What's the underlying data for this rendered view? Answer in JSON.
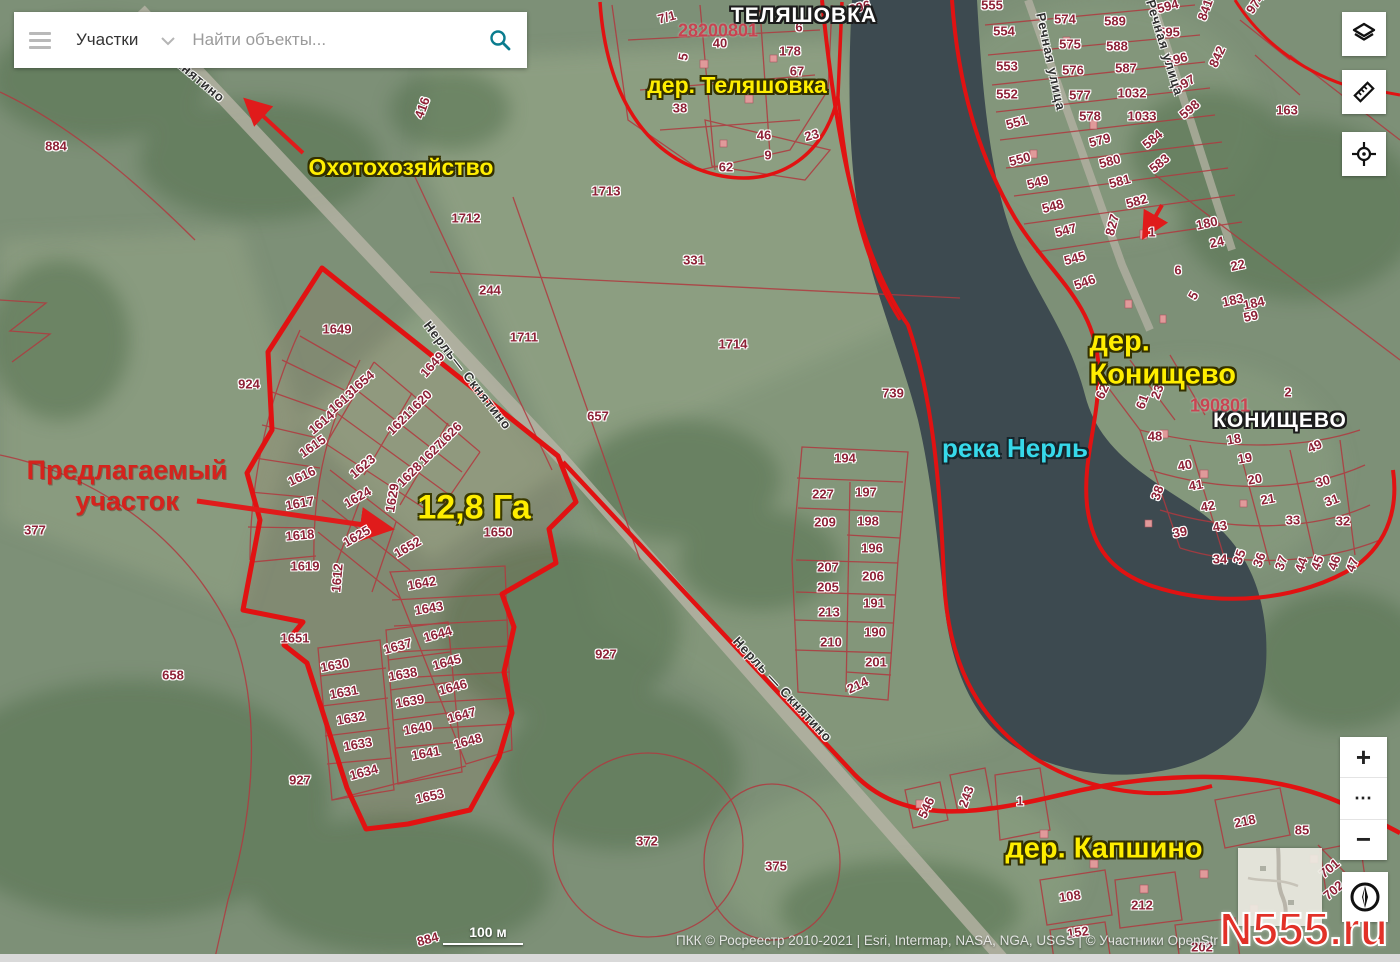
{
  "search": {
    "category": "Участки",
    "placeholder": "Найти объекты..."
  },
  "controls": {
    "layers_icon": "layers",
    "ruler_icon": "ruler",
    "locate_icon": "crosshair",
    "zoom_in": "+",
    "more": "⋯",
    "zoom_out": "−",
    "compass_icon": "compass"
  },
  "scale_bar": {
    "label": "100 м"
  },
  "attribution": "ПКК © Росреестр 2010-2021 | Esri, Intermap, NASA, NGA, USGS | © Участники OpenStr",
  "watermark": "N555.ru",
  "colors": {
    "accent_red": "#e11212",
    "label_yellow": "#ffee00",
    "river_cyan": "#37d9ea",
    "water": "#3d4a50"
  },
  "map_labels": [
    {
      "t": "ТЕЛЯШОВКА",
      "x": 804,
      "y": 16,
      "cls": "place",
      "name": "place-label-telyashovka"
    },
    {
      "t": "КОНИЩЕВО",
      "x": 1280,
      "y": 421,
      "cls": "place",
      "name": "place-label-konishchevo"
    },
    {
      "t": "дер. Теляшовка",
      "x": 737,
      "y": 85,
      "cls": "village",
      "name": "village-label-telyashovka"
    },
    {
      "t": "дер. Конищево",
      "x": 1193,
      "y": 359,
      "cls": "village-lg",
      "name": "village-label-konishchevo"
    },
    {
      "t": "дер. Капшино",
      "x": 1104,
      "y": 849,
      "cls": "village-lg",
      "name": "village-label-kapshino"
    },
    {
      "t": "Охотохозяйство",
      "x": 401,
      "y": 167,
      "cls": "village",
      "name": "hunting-ground-label"
    },
    {
      "t": "12,8 Га",
      "x": 474,
      "y": 508,
      "cls": "area-size",
      "name": "area-size-label"
    },
    {
      "t": "река Нерль",
      "x": 1015,
      "y": 449,
      "cls": "river",
      "name": "river-label"
    },
    {
      "t": "Предлагаемый\nучасток",
      "x": 127,
      "y": 486,
      "cls": "callout",
      "name": "proposed-parcel-callout"
    },
    {
      "t": "Скнятино",
      "x": 196,
      "y": 78,
      "cls": "road",
      "r": 40,
      "name": "road-label"
    },
    {
      "t": "Нерль— Скнятино",
      "x": 467,
      "y": 376,
      "cls": "road",
      "r": 52,
      "name": "road-label"
    },
    {
      "t": "Нерль — Скнятино",
      "x": 782,
      "y": 690,
      "cls": "road",
      "r": 47,
      "name": "road-label"
    },
    {
      "t": "Речная улица",
      "x": 1050,
      "y": 62,
      "cls": "road",
      "r": 78,
      "name": "street-label"
    },
    {
      "t": "Речная улица",
      "x": 1164,
      "y": 48,
      "cls": "road",
      "r": 73,
      "name": "street-label"
    },
    {
      "t": "28200801",
      "x": 718,
      "y": 31,
      "cls": "quarter",
      "name": "cadastral-quarter-number"
    },
    {
      "t": "190801",
      "x": 1220,
      "y": 406,
      "cls": "quarter",
      "name": "cadastral-quarter-number"
    }
  ],
  "parcels": [
    {
      "t": "884",
      "x": 56,
      "y": 147
    },
    {
      "t": "896",
      "x": 860,
      "y": 8,
      "r": -15
    },
    {
      "t": "416",
      "x": 423,
      "y": 108,
      "r": -70
    },
    {
      "t": "924",
      "x": 249,
      "y": 385
    },
    {
      "t": "377",
      "x": 35,
      "y": 531
    },
    {
      "t": "658",
      "x": 173,
      "y": 676
    },
    {
      "t": "884",
      "x": 428,
      "y": 940,
      "r": -15
    },
    {
      "t": "7/1",
      "x": 667,
      "y": 18,
      "r": -15
    },
    {
      "t": "40",
      "x": 720,
      "y": 44
    },
    {
      "t": "5",
      "x": 684,
      "y": 57,
      "r": -80
    },
    {
      "t": "6",
      "x": 799,
      "y": 28
    },
    {
      "t": "178",
      "x": 790,
      "y": 52
    },
    {
      "t": "67",
      "x": 797,
      "y": 72
    },
    {
      "t": "38",
      "x": 680,
      "y": 109
    },
    {
      "t": "46",
      "x": 764,
      "y": 136
    },
    {
      "t": "23",
      "x": 812,
      "y": 136,
      "r": -15
    },
    {
      "t": "9",
      "x": 768,
      "y": 156
    },
    {
      "t": "62",
      "x": 726,
      "y": 168
    },
    {
      "t": "1713",
      "x": 606,
      "y": 192
    },
    {
      "t": "1712",
      "x": 466,
      "y": 219
    },
    {
      "t": "331",
      "x": 694,
      "y": 261
    },
    {
      "t": "244",
      "x": 490,
      "y": 291
    },
    {
      "t": "1711",
      "x": 524,
      "y": 338
    },
    {
      "t": "1714",
      "x": 733,
      "y": 345
    },
    {
      "t": "657",
      "x": 598,
      "y": 417
    },
    {
      "t": "739",
      "x": 893,
      "y": 394
    },
    {
      "t": "1649",
      "x": 337,
      "y": 330
    },
    {
      "t": "1649",
      "x": 433,
      "y": 365,
      "r": -48
    },
    {
      "t": "1654",
      "x": 362,
      "y": 383,
      "r": -40
    },
    {
      "t": "1613",
      "x": 342,
      "y": 402,
      "r": -40
    },
    {
      "t": "1614",
      "x": 322,
      "y": 423,
      "r": -40
    },
    {
      "t": "1615",
      "x": 313,
      "y": 447,
      "r": -35
    },
    {
      "t": "1616",
      "x": 302,
      "y": 477,
      "r": -25
    },
    {
      "t": "1617",
      "x": 300,
      "y": 504,
      "r": -10
    },
    {
      "t": "1618",
      "x": 300,
      "y": 536,
      "r": -5
    },
    {
      "t": "1619",
      "x": 305,
      "y": 567
    },
    {
      "t": "1620",
      "x": 420,
      "y": 403,
      "r": -45
    },
    {
      "t": "1621",
      "x": 400,
      "y": 423,
      "r": -45
    },
    {
      "t": "1626",
      "x": 450,
      "y": 435,
      "r": -45
    },
    {
      "t": "1627",
      "x": 432,
      "y": 453,
      "r": -45
    },
    {
      "t": "1623",
      "x": 363,
      "y": 467,
      "r": -40
    },
    {
      "t": "1628",
      "x": 410,
      "y": 475,
      "r": -45
    },
    {
      "t": "1624",
      "x": 358,
      "y": 498,
      "r": -30
    },
    {
      "t": "1629",
      "x": 393,
      "y": 498,
      "r": -80
    },
    {
      "t": "1625",
      "x": 357,
      "y": 537,
      "r": -30
    },
    {
      "t": "1652",
      "x": 408,
      "y": 548,
      "r": -30
    },
    {
      "t": "1612",
      "x": 338,
      "y": 578,
      "r": -85
    },
    {
      "t": "1650",
      "x": 498,
      "y": 533
    },
    {
      "t": "1651",
      "x": 295,
      "y": 639
    },
    {
      "t": "927",
      "x": 300,
      "y": 781
    },
    {
      "t": "1642",
      "x": 422,
      "y": 584,
      "r": -10
    },
    {
      "t": "1643",
      "x": 429,
      "y": 609,
      "r": -10
    },
    {
      "t": "1637",
      "x": 398,
      "y": 647,
      "r": -15
    },
    {
      "t": "1644",
      "x": 438,
      "y": 635,
      "r": -15
    },
    {
      "t": "1645",
      "x": 447,
      "y": 663,
      "r": -15
    },
    {
      "t": "1630",
      "x": 335,
      "y": 666,
      "r": -10
    },
    {
      "t": "1638",
      "x": 403,
      "y": 675,
      "r": -10
    },
    {
      "t": "1646",
      "x": 453,
      "y": 688,
      "r": -15
    },
    {
      "t": "1631",
      "x": 344,
      "y": 693,
      "r": -10
    },
    {
      "t": "1639",
      "x": 410,
      "y": 702,
      "r": -10
    },
    {
      "t": "1632",
      "x": 351,
      "y": 719,
      "r": -10
    },
    {
      "t": "1647",
      "x": 462,
      "y": 716,
      "r": -15
    },
    {
      "t": "1640",
      "x": 418,
      "y": 729,
      "r": -10
    },
    {
      "t": "1633",
      "x": 358,
      "y": 745,
      "r": -10
    },
    {
      "t": "1648",
      "x": 468,
      "y": 742,
      "r": -15
    },
    {
      "t": "1641",
      "x": 426,
      "y": 754,
      "r": -10
    },
    {
      "t": "1634",
      "x": 364,
      "y": 773,
      "r": -15
    },
    {
      "t": "1653",
      "x": 430,
      "y": 797,
      "r": -12
    },
    {
      "t": "194",
      "x": 845,
      "y": 459
    },
    {
      "t": "227",
      "x": 823,
      "y": 495
    },
    {
      "t": "197",
      "x": 866,
      "y": 493
    },
    {
      "t": "209",
      "x": 825,
      "y": 523
    },
    {
      "t": "198",
      "x": 868,
      "y": 522
    },
    {
      "t": "196",
      "x": 872,
      "y": 549
    },
    {
      "t": "207",
      "x": 828,
      "y": 568
    },
    {
      "t": "206",
      "x": 873,
      "y": 577
    },
    {
      "t": "205",
      "x": 828,
      "y": 588
    },
    {
      "t": "213",
      "x": 829,
      "y": 613
    },
    {
      "t": "191",
      "x": 874,
      "y": 604
    },
    {
      "t": "210",
      "x": 831,
      "y": 643
    },
    {
      "t": "190",
      "x": 875,
      "y": 633
    },
    {
      "t": "201",
      "x": 876,
      "y": 663
    },
    {
      "t": "214",
      "x": 858,
      "y": 686,
      "r": -25
    },
    {
      "t": "555",
      "x": 992,
      "y": 6
    },
    {
      "t": "554",
      "x": 1004,
      "y": 32
    },
    {
      "t": "553",
      "x": 1007,
      "y": 67
    },
    {
      "t": "552",
      "x": 1007,
      "y": 95
    },
    {
      "t": "551",
      "x": 1017,
      "y": 123,
      "r": -15
    },
    {
      "t": "550",
      "x": 1020,
      "y": 160,
      "r": -15
    },
    {
      "t": "549",
      "x": 1038,
      "y": 183,
      "r": -15
    },
    {
      "t": "548",
      "x": 1053,
      "y": 207,
      "r": -15
    },
    {
      "t": "547",
      "x": 1066,
      "y": 231,
      "r": -15
    },
    {
      "t": "545",
      "x": 1075,
      "y": 259,
      "r": -15
    },
    {
      "t": "546",
      "x": 1085,
      "y": 283,
      "r": -20
    },
    {
      "t": "574",
      "x": 1065,
      "y": 20
    },
    {
      "t": "575",
      "x": 1070,
      "y": 45
    },
    {
      "t": "576",
      "x": 1073,
      "y": 71
    },
    {
      "t": "577",
      "x": 1080,
      "y": 96
    },
    {
      "t": "578",
      "x": 1090,
      "y": 117
    },
    {
      "t": "579",
      "x": 1100,
      "y": 141,
      "r": -15
    },
    {
      "t": "580",
      "x": 1110,
      "y": 162,
      "r": -15
    },
    {
      "t": "581",
      "x": 1120,
      "y": 182,
      "r": -15
    },
    {
      "t": "582",
      "x": 1137,
      "y": 202,
      "r": -15
    },
    {
      "t": "589",
      "x": 1115,
      "y": 22
    },
    {
      "t": "588",
      "x": 1117,
      "y": 47
    },
    {
      "t": "587",
      "x": 1126,
      "y": 69
    },
    {
      "t": "1032",
      "x": 1132,
      "y": 94
    },
    {
      "t": "1033",
      "x": 1142,
      "y": 117
    },
    {
      "t": "584",
      "x": 1153,
      "y": 140,
      "r": -40
    },
    {
      "t": "583",
      "x": 1160,
      "y": 164,
      "r": -40
    },
    {
      "t": "594",
      "x": 1168,
      "y": 7,
      "r": -15
    },
    {
      "t": "595",
      "x": 1169,
      "y": 33
    },
    {
      "t": "596",
      "x": 1177,
      "y": 60,
      "r": -15
    },
    {
      "t": "597",
      "x": 1185,
      "y": 84,
      "r": -30
    },
    {
      "t": "598",
      "x": 1190,
      "y": 110,
      "r": -40
    },
    {
      "t": "827",
      "x": 1113,
      "y": 225,
      "r": -75
    },
    {
      "t": "841",
      "x": 1206,
      "y": 10,
      "r": -70
    },
    {
      "t": "842",
      "x": 1218,
      "y": 57,
      "r": -65
    },
    {
      "t": "974",
      "x": 1256,
      "y": 4,
      "r": -55
    },
    {
      "t": "163",
      "x": 1287,
      "y": 111
    },
    {
      "t": "1",
      "x": 1152,
      "y": 233
    },
    {
      "t": "180",
      "x": 1207,
      "y": 224,
      "r": -12
    },
    {
      "t": "24",
      "x": 1217,
      "y": 243,
      "r": -12
    },
    {
      "t": "22",
      "x": 1238,
      "y": 266,
      "r": -12
    },
    {
      "t": "6",
      "x": 1178,
      "y": 271
    },
    {
      "t": "5",
      "x": 1194,
      "y": 296,
      "r": -60
    },
    {
      "t": "183",
      "x": 1233,
      "y": 301,
      "r": -12
    },
    {
      "t": "184",
      "x": 1254,
      "y": 304,
      "r": -12
    },
    {
      "t": "59",
      "x": 1251,
      "y": 317,
      "r": -12
    },
    {
      "t": "62",
      "x": 1103,
      "y": 392,
      "r": -65
    },
    {
      "t": "61",
      "x": 1143,
      "y": 402,
      "r": -70
    },
    {
      "t": "23",
      "x": 1158,
      "y": 392,
      "r": -70
    },
    {
      "t": "10",
      "x": 1190,
      "y": 377,
      "r": -10
    },
    {
      "t": "2",
      "x": 1288,
      "y": 393
    },
    {
      "t": "48",
      "x": 1155,
      "y": 437
    },
    {
      "t": "18",
      "x": 1234,
      "y": 440,
      "r": -10
    },
    {
      "t": "19",
      "x": 1245,
      "y": 459,
      "r": -10
    },
    {
      "t": "20",
      "x": 1255,
      "y": 480,
      "r": -10
    },
    {
      "t": "21",
      "x": 1268,
      "y": 500,
      "r": -10
    },
    {
      "t": "40",
      "x": 1185,
      "y": 466,
      "r": -10
    },
    {
      "t": "41",
      "x": 1196,
      "y": 486,
      "r": -10
    },
    {
      "t": "42",
      "x": 1208,
      "y": 507,
      "r": -10
    },
    {
      "t": "43",
      "x": 1220,
      "y": 527,
      "r": -10
    },
    {
      "t": "38",
      "x": 1158,
      "y": 493,
      "r": -70
    },
    {
      "t": "39",
      "x": 1180,
      "y": 533,
      "r": -10
    },
    {
      "t": "49",
      "x": 1315,
      "y": 447,
      "r": -25
    },
    {
      "t": "30",
      "x": 1323,
      "y": 482,
      "r": -15
    },
    {
      "t": "31",
      "x": 1332,
      "y": 501,
      "r": -20
    },
    {
      "t": "32",
      "x": 1343,
      "y": 522
    },
    {
      "t": "33",
      "x": 1293,
      "y": 521
    },
    {
      "t": "34",
      "x": 1220,
      "y": 560
    },
    {
      "t": "35",
      "x": 1240,
      "y": 557,
      "r": -70
    },
    {
      "t": "36",
      "x": 1260,
      "y": 560,
      "r": -70
    },
    {
      "t": "37",
      "x": 1282,
      "y": 563,
      "r": -70
    },
    {
      "t": "44",
      "x": 1302,
      "y": 565,
      "r": -70
    },
    {
      "t": "45",
      "x": 1318,
      "y": 563,
      "r": -70
    },
    {
      "t": "46",
      "x": 1335,
      "y": 563,
      "r": -70
    },
    {
      "t": "47",
      "x": 1353,
      "y": 565,
      "r": -70
    },
    {
      "t": "927",
      "x": 606,
      "y": 655
    },
    {
      "t": "372",
      "x": 647,
      "y": 842
    },
    {
      "t": "375",
      "x": 776,
      "y": 867
    },
    {
      "t": "546",
      "x": 927,
      "y": 808,
      "r": -65
    },
    {
      "t": "243",
      "x": 967,
      "y": 797,
      "r": -70
    },
    {
      "t": "1",
      "x": 1020,
      "y": 802
    },
    {
      "t": "218",
      "x": 1245,
      "y": 822,
      "r": -12
    },
    {
      "t": "85",
      "x": 1302,
      "y": 831
    },
    {
      "t": "108",
      "x": 1070,
      "y": 897,
      "r": -8
    },
    {
      "t": "212",
      "x": 1142,
      "y": 906
    },
    {
      "t": "152",
      "x": 1078,
      "y": 933,
      "r": -8
    },
    {
      "t": "202",
      "x": 1202,
      "y": 948
    },
    {
      "t": "701",
      "x": 1330,
      "y": 869,
      "r": -40
    },
    {
      "t": "702",
      "x": 1334,
      "y": 891,
      "r": -40
    }
  ]
}
